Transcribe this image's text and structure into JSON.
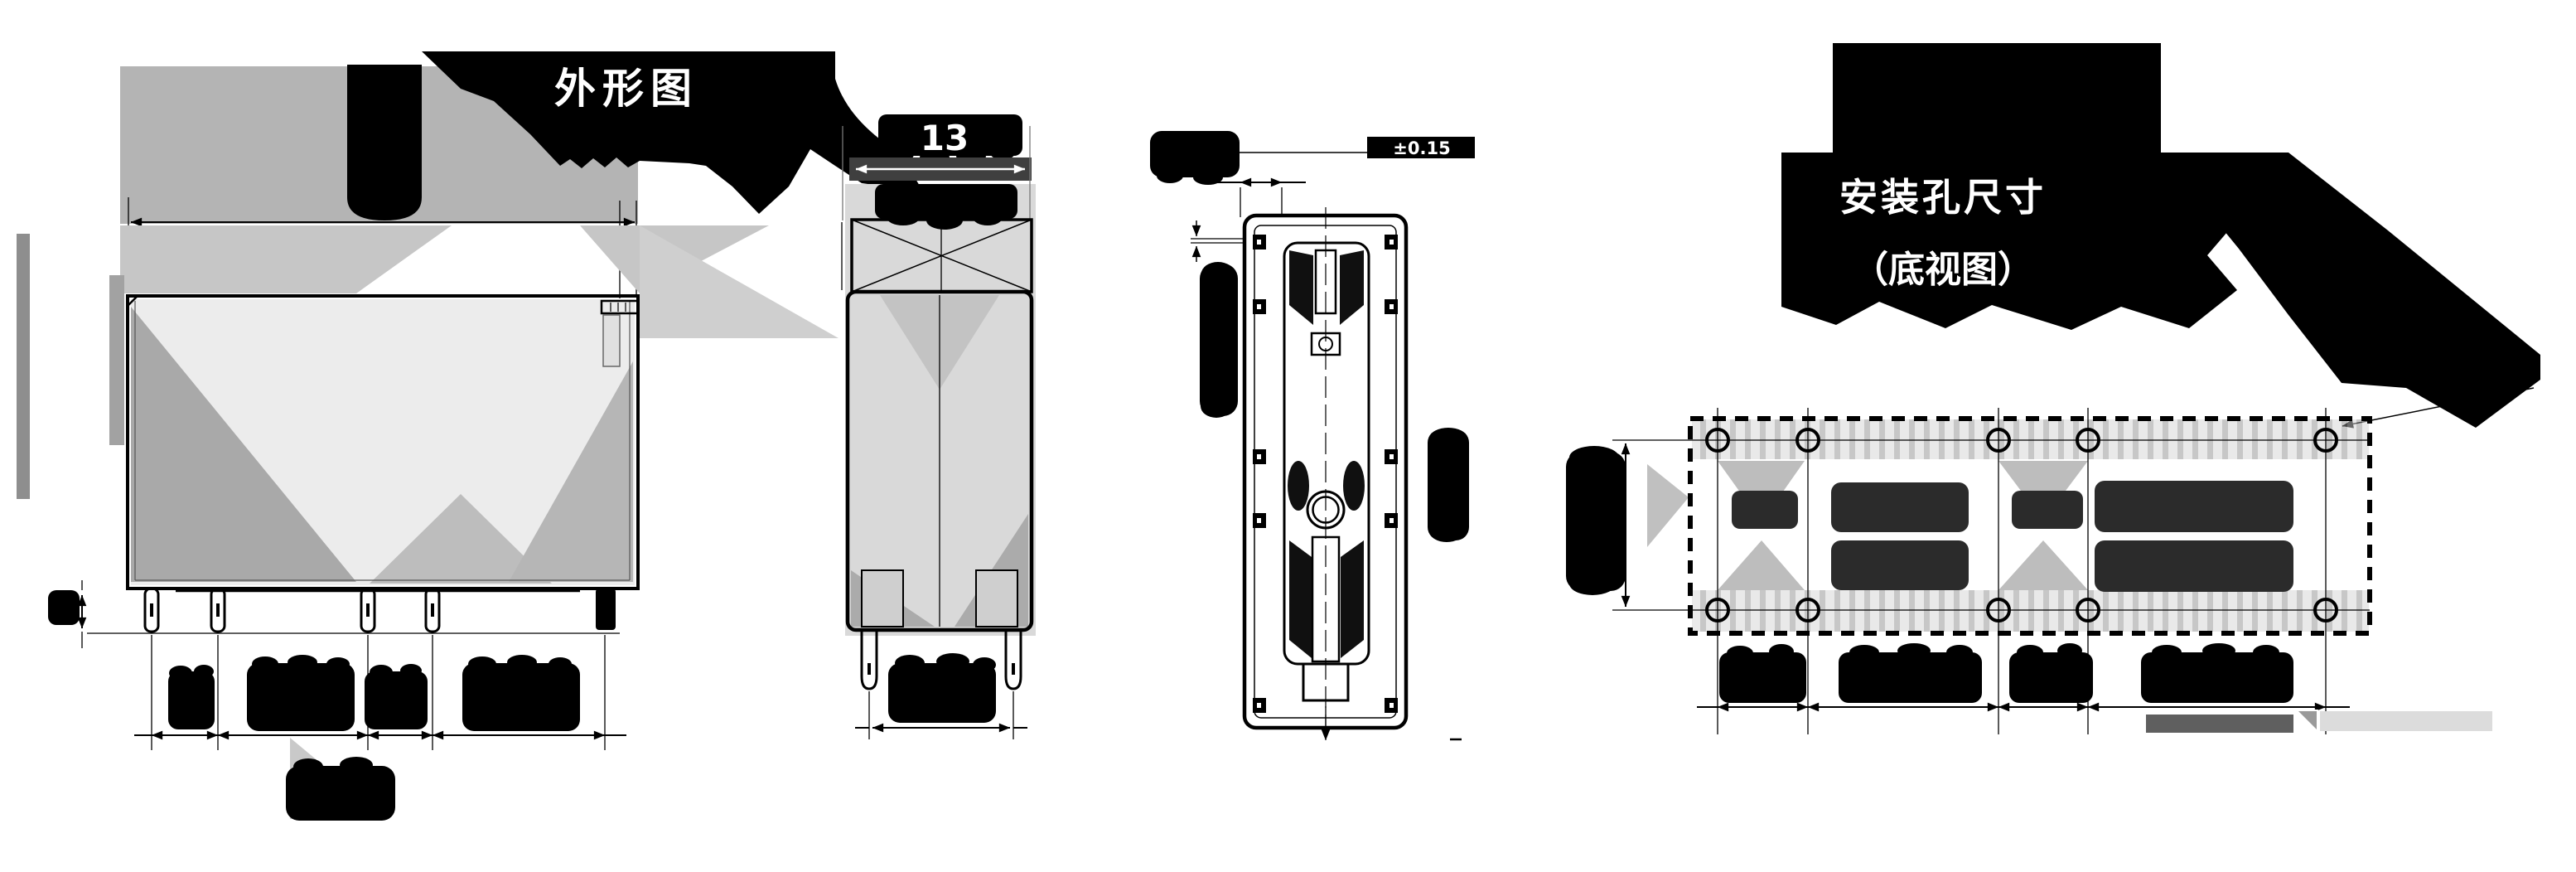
{
  "page": {
    "background": "#ffffff"
  },
  "drawing": {
    "ink_color": "#000000",
    "label_text_color": "#ffffff",
    "shade_dark": "#3f3f3f",
    "shade_mid": "#b4b4b4",
    "views": {
      "front": {
        "title": "外形图"
      },
      "side": {
        "width_dim": "13"
      },
      "top": {
        "tolerance_dim": "±0.15"
      },
      "bottom": {
        "title": "安装孔尺寸",
        "subtitle": "（底视图）"
      }
    }
  }
}
